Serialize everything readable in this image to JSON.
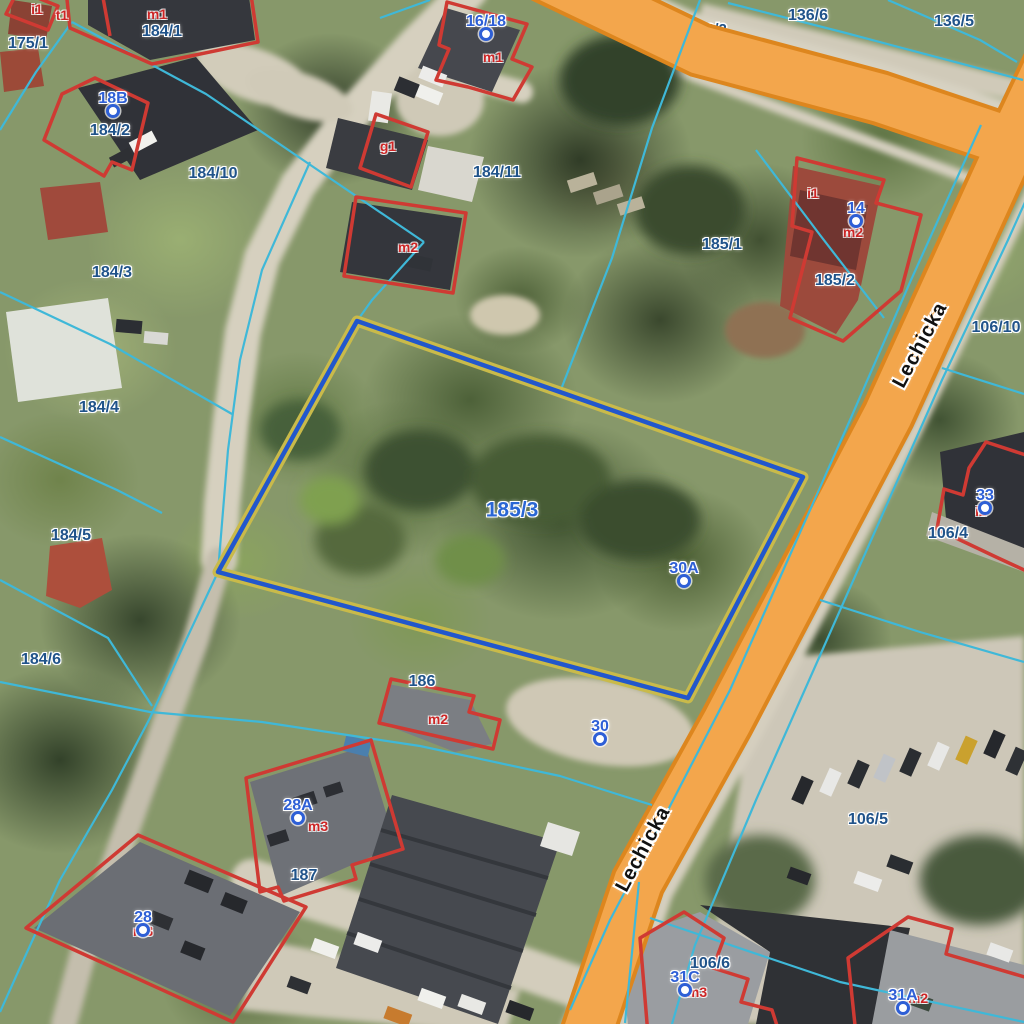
{
  "map": {
    "street_labels": [
      {
        "text": "Lechicka",
        "x": 920,
        "y": 345,
        "rotation": -62
      },
      {
        "text": "Lechicka",
        "x": 643,
        "y": 849,
        "rotation": -62
      }
    ],
    "selected_parcel": {
      "label": "185/3",
      "x": 512,
      "y": 510
    },
    "hidden_parcel_label": {
      "text": "3/2",
      "x": 722,
      "y": 30
    },
    "parcel_labels": [
      {
        "text": "175/1",
        "x": 28,
        "y": 44
      },
      {
        "text": "184/1",
        "x": 162,
        "y": 32
      },
      {
        "text": "184/2",
        "x": 110,
        "y": 131
      },
      {
        "text": "184/10",
        "x": 213,
        "y": 174
      },
      {
        "text": "184/11",
        "x": 497,
        "y": 173
      },
      {
        "text": "184/3",
        "x": 112,
        "y": 273
      },
      {
        "text": "184/4",
        "x": 99,
        "y": 408
      },
      {
        "text": "184/5",
        "x": 71,
        "y": 536
      },
      {
        "text": "184/6",
        "x": 41,
        "y": 660
      },
      {
        "text": "185/1",
        "x": 722,
        "y": 245
      },
      {
        "text": "185/2",
        "x": 835,
        "y": 281
      },
      {
        "text": "136/6",
        "x": 808,
        "y": 16
      },
      {
        "text": "136/5",
        "x": 954,
        "y": 22
      },
      {
        "text": "106/10",
        "x": 996,
        "y": 328
      },
      {
        "text": "106/4",
        "x": 948,
        "y": 534
      },
      {
        "text": "106/5",
        "x": 868,
        "y": 820
      },
      {
        "text": "106/6",
        "x": 710,
        "y": 964
      },
      {
        "text": "186",
        "x": 422,
        "y": 682
      },
      {
        "text": "187",
        "x": 304,
        "y": 876
      }
    ],
    "address_points": [
      {
        "label": "18B",
        "x": 113,
        "y": 99
      },
      {
        "label": "16/18",
        "x": 486,
        "y": 22
      },
      {
        "label": "14",
        "x": 856,
        "y": 209
      },
      {
        "label": "33",
        "x": 985,
        "y": 496
      },
      {
        "label": "30A",
        "x": 684,
        "y": 569
      },
      {
        "label": "30",
        "x": 600,
        "y": 727
      },
      {
        "label": "28A",
        "x": 298,
        "y": 806
      },
      {
        "label": "28",
        "x": 143,
        "y": 918
      },
      {
        "label": "31C",
        "x": 685,
        "y": 978
      },
      {
        "label": "31A",
        "x": 903,
        "y": 996
      }
    ],
    "building_labels": [
      {
        "text": "i1",
        "x": 37,
        "y": 9
      },
      {
        "text": "t1",
        "x": 62,
        "y": 15
      },
      {
        "text": "m1",
        "x": 157,
        "y": 14
      },
      {
        "text": "m1",
        "x": 493,
        "y": 57
      },
      {
        "text": "g1",
        "x": 388,
        "y": 146
      },
      {
        "text": "m2",
        "x": 408,
        "y": 247
      },
      {
        "text": "i1",
        "x": 813,
        "y": 193
      },
      {
        "text": "m2",
        "x": 853,
        "y": 232
      },
      {
        "text": "m2",
        "x": 438,
        "y": 719
      },
      {
        "text": "m3",
        "x": 318,
        "y": 826
      },
      {
        "text": "m3",
        "x": 143,
        "y": 931
      },
      {
        "text": "m3",
        "x": 697,
        "y": 992
      },
      {
        "text": "m2",
        "x": 918,
        "y": 998
      },
      {
        "text": "i2",
        "x": 981,
        "y": 511
      }
    ],
    "colors": {
      "parcel_line": "#3fb8d8",
      "building_outline": "#cf3a33",
      "road_fill": "#f3a64c",
      "road_casing": "#dd861e",
      "highlight_outer": "#c9ba4a",
      "highlight_inner": "#2257cc",
      "parcel_label": "#20538a",
      "address_label": "#2e5fd6",
      "building_label": "#cc2525",
      "street_label": "#111111",
      "selected_label": "#2a66d4"
    }
  }
}
